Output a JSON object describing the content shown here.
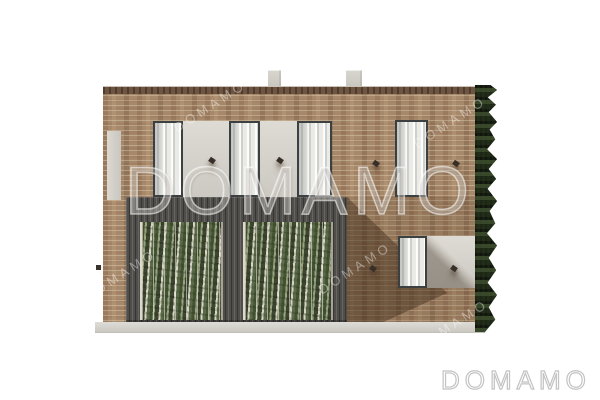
{
  "image": {
    "type": "architectural-elevation-render",
    "subject": "Front elevation of a two-storey brick house with dark slatted ground-floor cladding, two climbing-plant green walls, five tall windows, wall sconces, two roof chimneys and an ivy-covered right edge"
  },
  "watermark": {
    "large_text": "DOMAMO",
    "small_text": "DOMAMO"
  },
  "brand": {
    "logo_text": "DOMAMO"
  },
  "palette": {
    "background": "#ffffff",
    "brick_light": "#a6896a",
    "brick_coping": "#6e5541",
    "slat_cladding": "#504e4a",
    "foliage_green": "#344426",
    "concrete_panel": "#d8d5ce",
    "window_frame": "#3c4040",
    "ivy_green": "#242f1b",
    "base_plinth": "#d8d6d0",
    "logo_outline": "#c3c3c3"
  }
}
